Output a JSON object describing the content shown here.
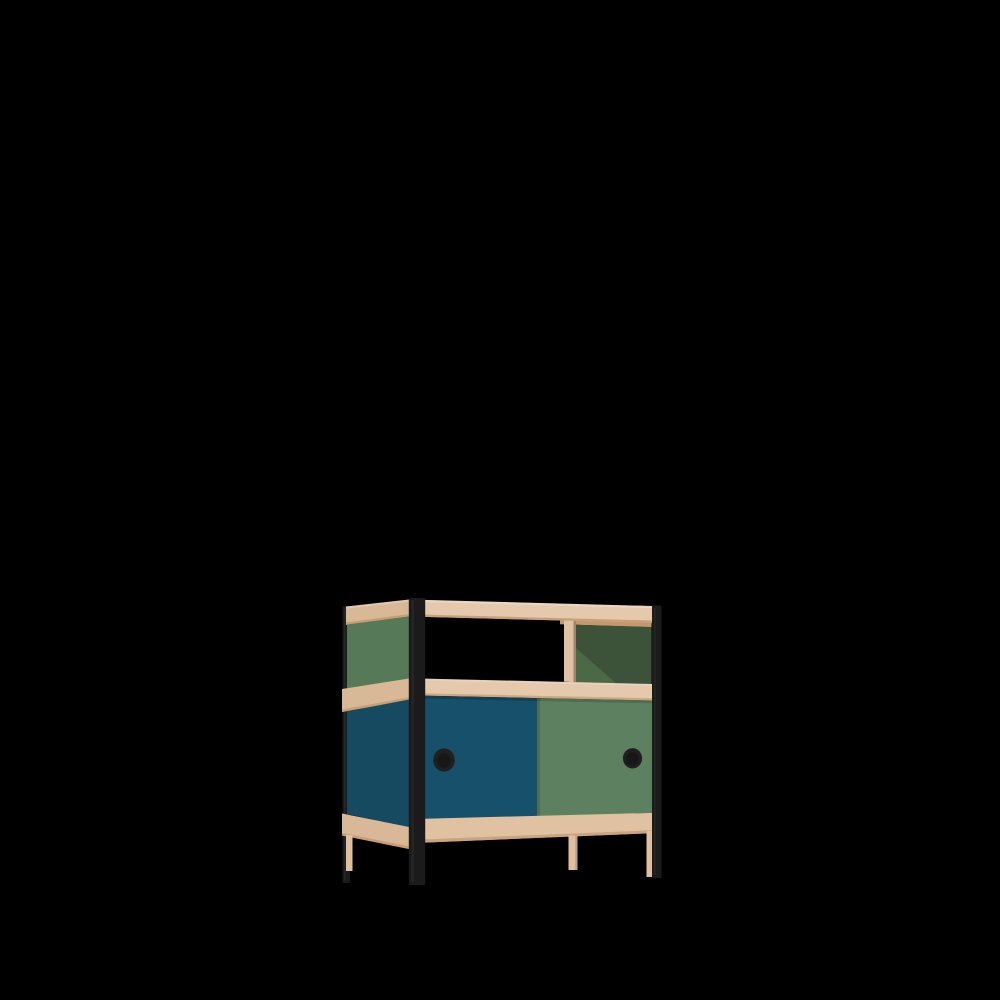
{
  "meta": {
    "description": "3D product render of a small modular sideboard on a black background: black steel corner posts, light wood shelves and rails, an open upper compartment with a dark green back panel on the right, and a lower cabinet with a petrol-blue and a green sliding door, each with a round black recessed handle.",
    "background": "#000000"
  },
  "furniture": {
    "name": "sideboard-with-sliding-doors",
    "colors": {
      "background": "#000000",
      "metal_frame": "#1b1b1b",
      "metal_highlight": "#3a3a3a",
      "wood_light": "#e5c9ac",
      "wood_front": "#e0c1a2",
      "wood_side": "#d9b897",
      "wood_under": "#c2996f",
      "wood_leg": "#dfbf9f",
      "door_blue": "#17506a",
      "side_blue": "#154a61",
      "door_green": "#5d8160",
      "side_green": "#567a57",
      "back_panel_green": "#3d5339",
      "back_panel_highlight": "#4d6c47",
      "handle_black": "#1f1f1f"
    }
  }
}
